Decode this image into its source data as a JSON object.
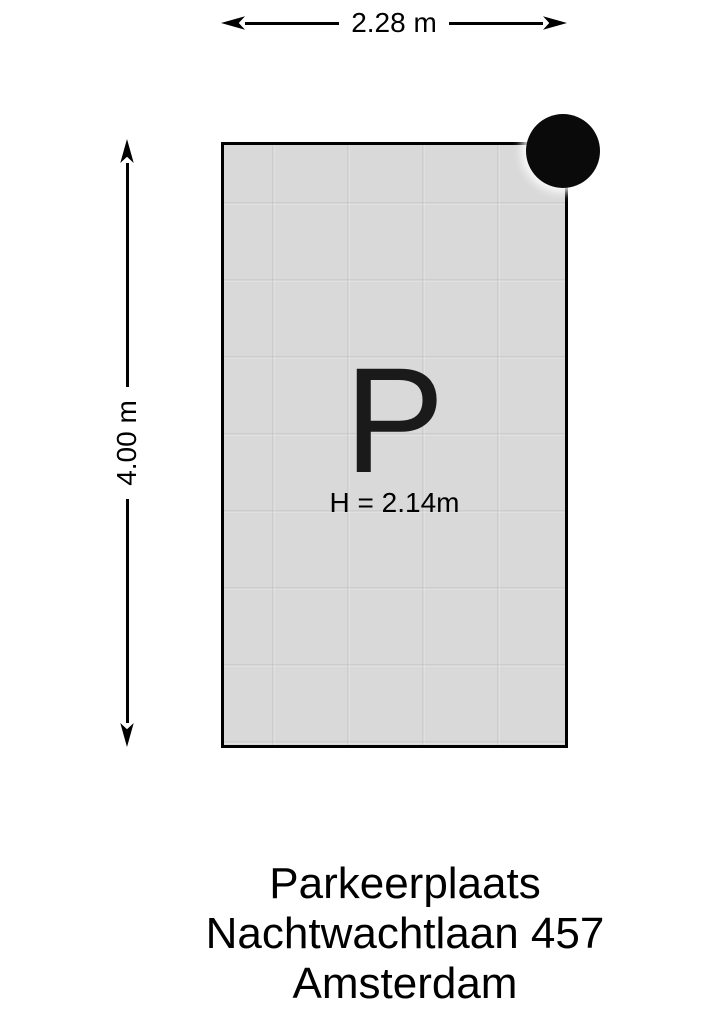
{
  "dimensions": {
    "width_label": "2.28 m",
    "height_label": "4.00 m"
  },
  "plan": {
    "parking_symbol": "P",
    "clearance_label": "H = 2.14m"
  },
  "caption": {
    "line1": "Parkeerplaats",
    "line2": "Nachtwachtlaan 457",
    "line3": "Amsterdam"
  },
  "colors": {
    "space_fill": "#d9d9d9",
    "outline": "#000000",
    "pillar": "#0a0a0a",
    "text": "#000000",
    "background": "#ffffff"
  }
}
